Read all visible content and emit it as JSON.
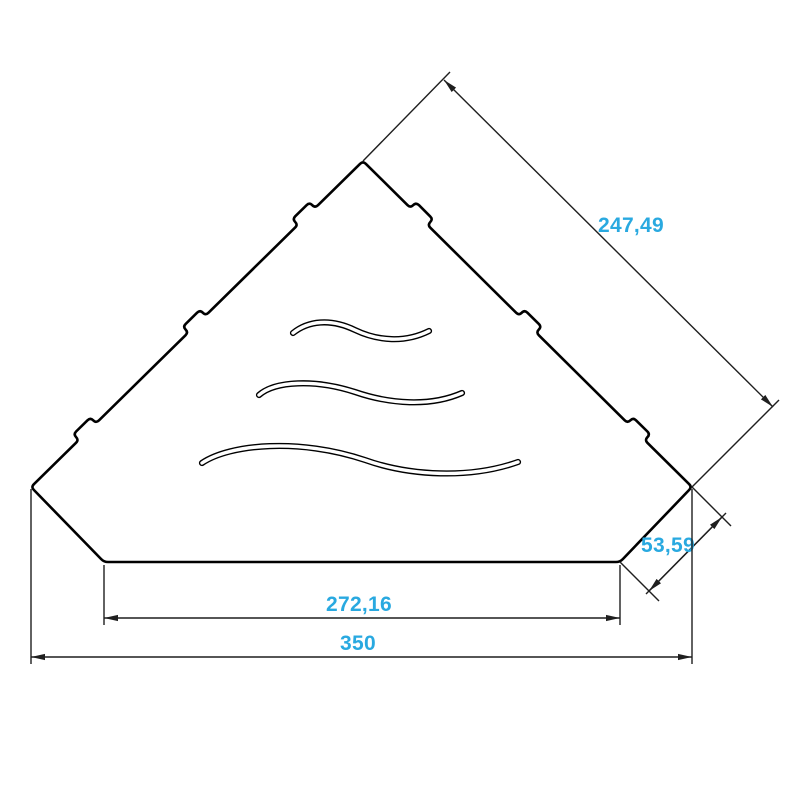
{
  "drawing": {
    "description": "Technical dimension drawing of a corner shelf plate with three wave-shaped cutout slots and stepped mounting tabs on the two back edges",
    "dimensions": {
      "side_edge": {
        "label": "247,49"
      },
      "corner_cut": {
        "label": "53,59"
      },
      "front_edge": {
        "label": "272,16"
      },
      "overall_width": {
        "label": "350"
      }
    },
    "colors": {
      "dimension_text": "#29A9E0",
      "outline": "#000000",
      "dimension_lines": "#1F1F1F",
      "background": "#FFFFFF"
    }
  }
}
